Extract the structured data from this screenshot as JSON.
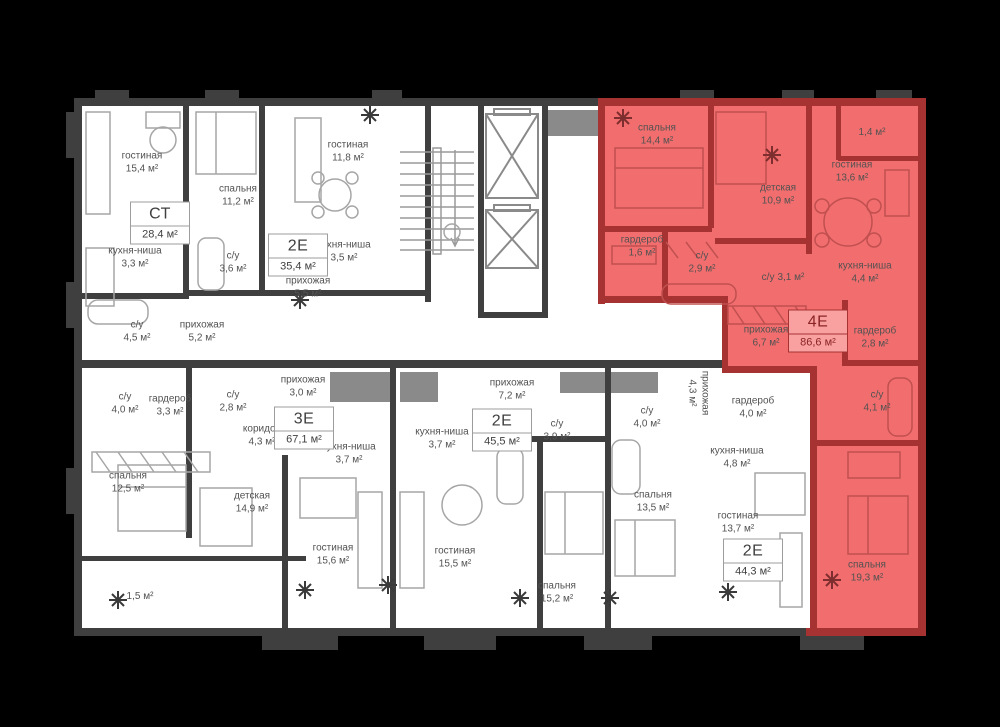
{
  "plan": {
    "title": "floor-plan",
    "unit": "м²",
    "colors": {
      "background": "#000000",
      "floor": "#ffffff",
      "walls": "#3f3f3f",
      "highlight_fill": "#f26d6d",
      "highlight_walls": "#a63232",
      "badge_highlight_bg": "#f9a0a0"
    }
  },
  "apartments": [
    {
      "code": "СТ",
      "area": "28,4 м²",
      "highlighted": false
    },
    {
      "code": "2Е",
      "area": "35,4 м²",
      "highlighted": false
    },
    {
      "code": "3Е",
      "area": "67,1 м²",
      "highlighted": false
    },
    {
      "code": "2Е",
      "area": "45,5 м²",
      "highlighted": false
    },
    {
      "code": "2Е",
      "area": "44,3 м²",
      "highlighted": false
    },
    {
      "code": "4Е",
      "area": "86,6 м²",
      "highlighted": true
    }
  ],
  "rooms": [
    {
      "name": "гостиная",
      "area": "15,4 м²"
    },
    {
      "name": "кухня-ниша",
      "area": "3,3 м²"
    },
    {
      "name": "с/у",
      "area": "4,5 м²"
    },
    {
      "name": "прихожая",
      "area": "5,2 м²"
    },
    {
      "name": "спальня",
      "area": "11,2 м²"
    },
    {
      "name": "с/у",
      "area": "3,6 м²"
    },
    {
      "name": "гостиная",
      "area": "11,8 м²"
    },
    {
      "name": "кухня-ниша",
      "area": "3,5 м²"
    },
    {
      "name": "прихожая",
      "area": "5,5 м²"
    },
    {
      "name": "с/у",
      "area": "4,0 м²"
    },
    {
      "name": "гардероб",
      "area": "3,3 м²"
    },
    {
      "name": "с/у",
      "area": "2,8 м²"
    },
    {
      "name": "коридор",
      "area": "4,3 м²"
    },
    {
      "name": "прихожая",
      "area": "3,0 м²"
    },
    {
      "name": "кухня-ниша",
      "area": "3,7 м²"
    },
    {
      "name": "спальня",
      "area": "12,5 м²"
    },
    {
      "name": "детская",
      "area": "14,9 м²"
    },
    {
      "name": "гостиная",
      "area": "15,6 м²"
    },
    {
      "name": "",
      "area": "1,5 м²"
    },
    {
      "name": "кухня-ниша",
      "area": "3,7 м²"
    },
    {
      "name": "прихожая",
      "area": "7,2 м²"
    },
    {
      "name": "с/у",
      "area": "3,9 м²"
    },
    {
      "name": "гостиная",
      "area": "15,5 м²"
    },
    {
      "name": "спальня",
      "area": "15,2 м²"
    },
    {
      "name": "с/у",
      "area": "4,0 м²"
    },
    {
      "name": "прихожая",
      "area": "4,3 м²"
    },
    {
      "name": "гардероб",
      "area": "4,0 м²"
    },
    {
      "name": "кухня-ниша",
      "area": "4,8 м²"
    },
    {
      "name": "спальня",
      "area": "13,5 м²"
    },
    {
      "name": "гостиная",
      "area": "13,7 м²"
    },
    {
      "name": "спальня",
      "area": "14,4 м²"
    },
    {
      "name": "детская",
      "area": "10,9 м²"
    },
    {
      "name": "гостиная",
      "area": "13,6 м²"
    },
    {
      "name": "",
      "area": "1,4 м²"
    },
    {
      "name": "гардероб",
      "area": "1,6 м²"
    },
    {
      "name": "с/у",
      "area": "2,9 м²"
    },
    {
      "name": "с/у",
      "area": "3,1 м²"
    },
    {
      "name": "кухня-ниша",
      "area": "4,4 м²"
    },
    {
      "name": "прихожая",
      "area": "6,7 м²"
    },
    {
      "name": "гардероб",
      "area": "2,8 м²"
    },
    {
      "name": "с/у",
      "area": "4,1 м²"
    },
    {
      "name": "спальня",
      "area": "19,3 м²"
    }
  ]
}
